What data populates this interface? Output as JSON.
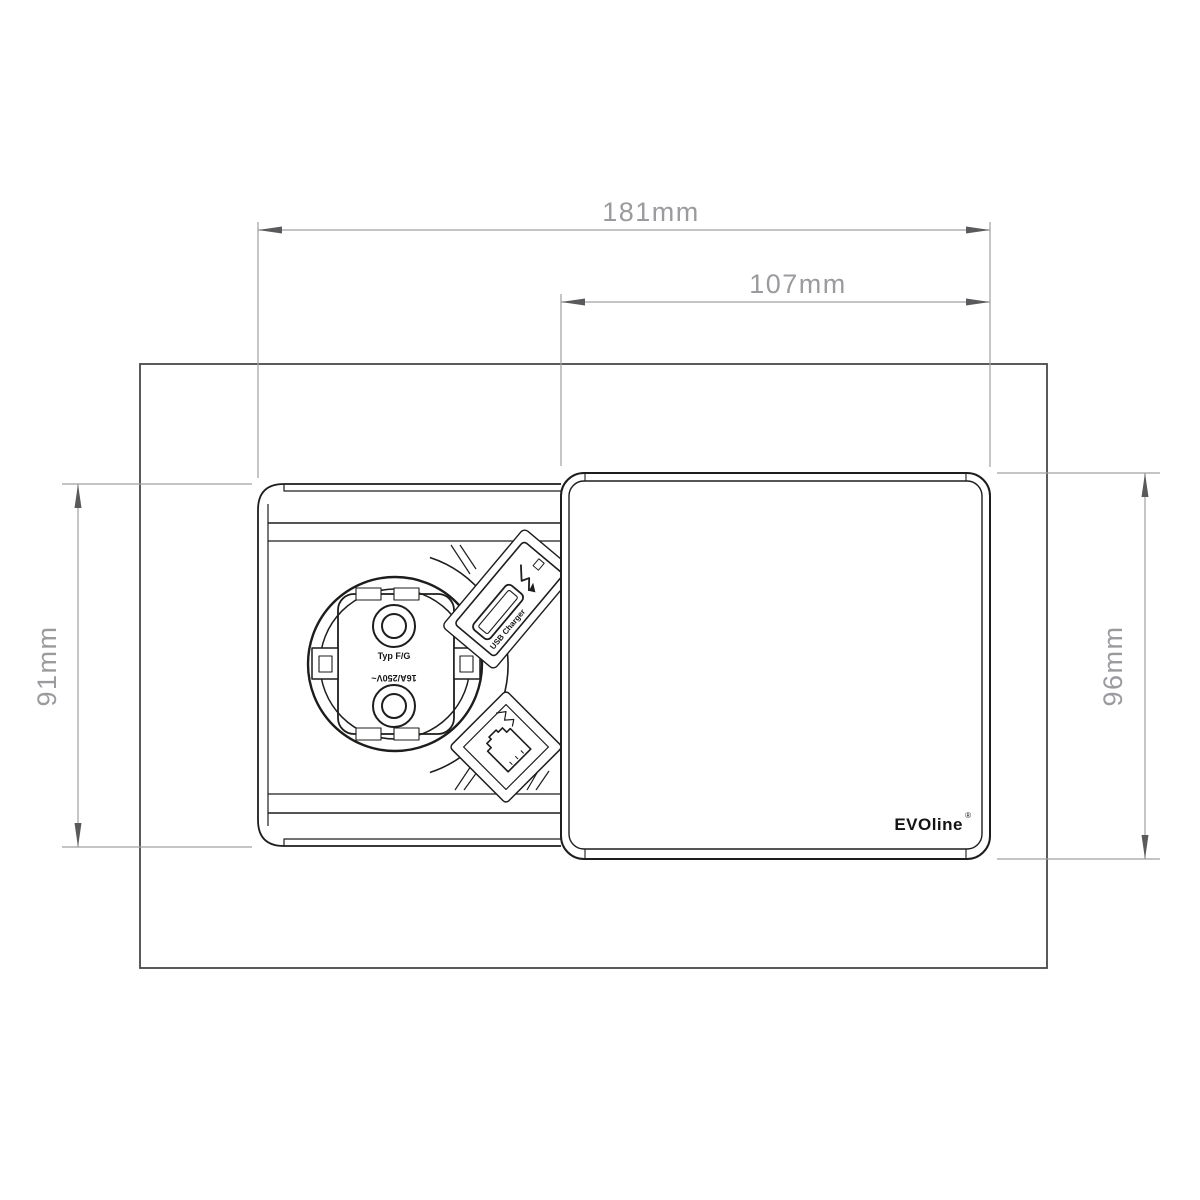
{
  "dimensions": {
    "total_width": "181mm",
    "cover_width": "107mm",
    "body_height": "91mm",
    "cover_height": "96mm"
  },
  "socket": {
    "type_label": "Typ F/G",
    "rating_label": "16A/250V~"
  },
  "usb_module": {
    "label": "USB Charger"
  },
  "cover": {
    "brand": "EVOline",
    "registered": "®"
  },
  "colors": {
    "line": "#1d1d1b",
    "frame": "#48484a",
    "dim": "#a0a0a3",
    "dimtext": "#9b9b9f",
    "arrow": "#5a5a5c",
    "bg": "#ffffff"
  }
}
